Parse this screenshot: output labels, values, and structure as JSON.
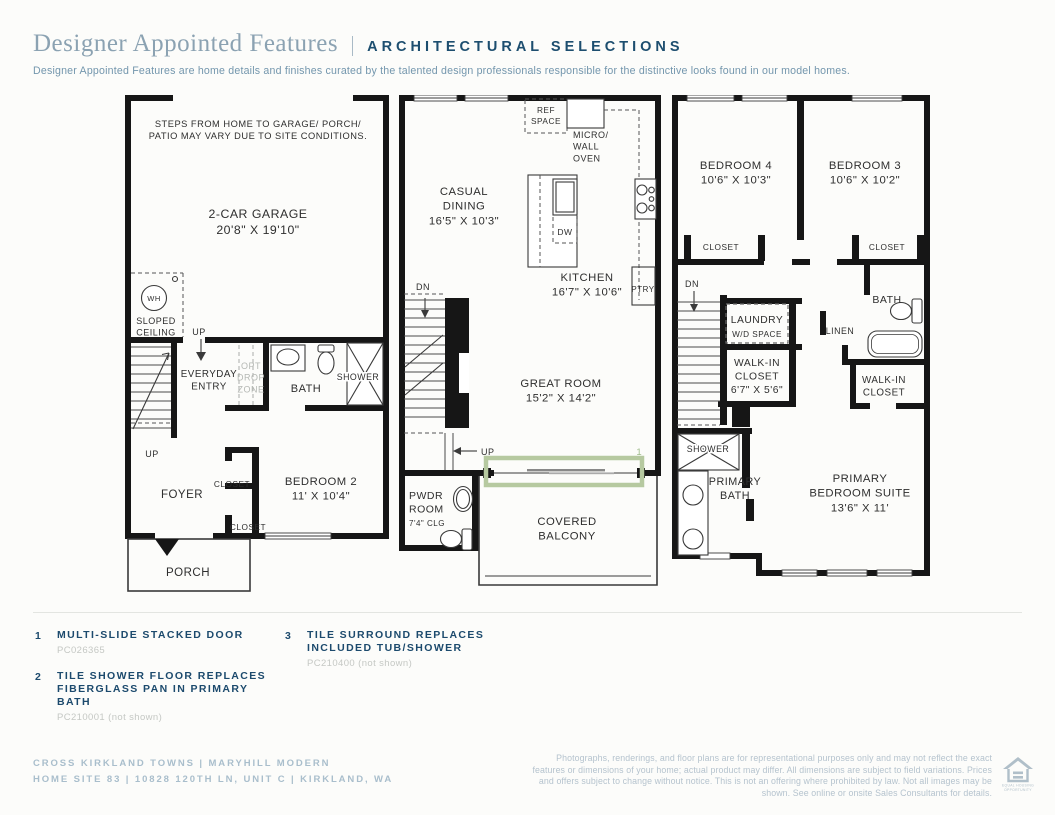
{
  "header": {
    "title": "Designer Appointed Features",
    "subtitle_caps": "ARCHITECTURAL SELECTIONS",
    "description": "Designer Appointed Features are home details and finishes curated by the talented design professionals responsible for the distinctive looks found in our model homes."
  },
  "plans": {
    "garage": {
      "note": "STEPS FROM HOME TO GARAGE/ PORCH/\nPATIO MAY VARY DUE TO SITE CONDITIONS.",
      "garage": "2-CAR GARAGE\n20'8\" X 19'10\"",
      "wh": "WH",
      "sloped_ceiling": "SLOPED\nCEILING",
      "up1": "UP",
      "everyday_entry": "EVERYDAY\nENTRY",
      "opt_drop_zone": "OPT\nDROP\nZONE",
      "bath": "BATH",
      "shower": "SHOWER",
      "up2": "UP",
      "foyer": "FOYER",
      "closet1": "CLOSET",
      "closet2": "CLOSET",
      "bedroom2": "BEDROOM 2\n11' X 10'4\"",
      "porch": "PORCH"
    },
    "main": {
      "ref_space": "REF\nSPACE",
      "micro": "MICRO/\nWALL\nOVEN",
      "casual_dining": "CASUAL\nDINING\n16'5\" X 10'3\"",
      "dw": "DW",
      "kitchen": "KITCHEN\n16'7\" X 10'6\"",
      "ptry": "PTRY",
      "dn": "DN",
      "great_room": "GREAT ROOM\n15'2\" X 14'2\"",
      "up": "UP",
      "marker1": "1",
      "pwdr": "PWDR\nROOM",
      "pwdr_clg": "7'4\" CLG",
      "balcony": "COVERED\nBALCONY"
    },
    "upper": {
      "bedroom4": "BEDROOM 4\n10'6\" X 10'3\"",
      "bedroom3": "BEDROOM 3\n10'6\" X 10'2\"",
      "closet_left": "CLOSET",
      "closet_right": "CLOSET",
      "dn": "DN",
      "laundry": "LAUNDRY",
      "wd_space": "W/D SPACE",
      "linen": "LINEN",
      "bath": "BATH",
      "walkin_left": "WALK-IN\nCLOSET\n6'7\" X 5'6\"",
      "walkin_right": "WALK-IN\nCLOSET",
      "shower": "SHOWER",
      "primary_bath": "PRIMARY\nBATH",
      "primary_suite": "PRIMARY\nBEDROOM SUITE\n13'6\" X 11'"
    }
  },
  "legend": {
    "items": [
      {
        "num": "1",
        "label": "MULTI-SLIDE STACKED DOOR",
        "code": "PC026365"
      },
      {
        "num": "2",
        "label": "TILE SHOWER FLOOR REPLACES FIBERGLASS PAN IN PRIMARY BATH",
        "code": "PC210001 (not shown)"
      },
      {
        "num": "3",
        "label": "TILE SURROUND REPLACES INCLUDED TUB/SHOWER",
        "code": "PC210400 (not shown)"
      }
    ]
  },
  "footer": {
    "community_line": "CROSS KIRKLAND TOWNS  |  MARYHILL MODERN",
    "site_line": "HOME SITE 83  |  10828 120TH LN, UNIT C  |  KIRKLAND, WA",
    "disclaimer": "Photographs, renderings, and floor plans are for representational purposes only and may not reflect the exact features or dimensions of your home; actual product may differ. All dimensions are subject to field variations. Prices and offers subject to change without notice. This is not an offering where prohibited by law. Not all images may be shown. See online or onsite Sales Consultants for details.",
    "equal_housing_label": "EQUAL HOUSING\nOPPORTUNITY"
  },
  "colors": {
    "accent_navy": "#1d4e6f",
    "title_blue": "#8ba2b2",
    "highlight_green": "#b6c9a0",
    "footer_blue": "#a9becc",
    "wall_black": "#161616"
  }
}
